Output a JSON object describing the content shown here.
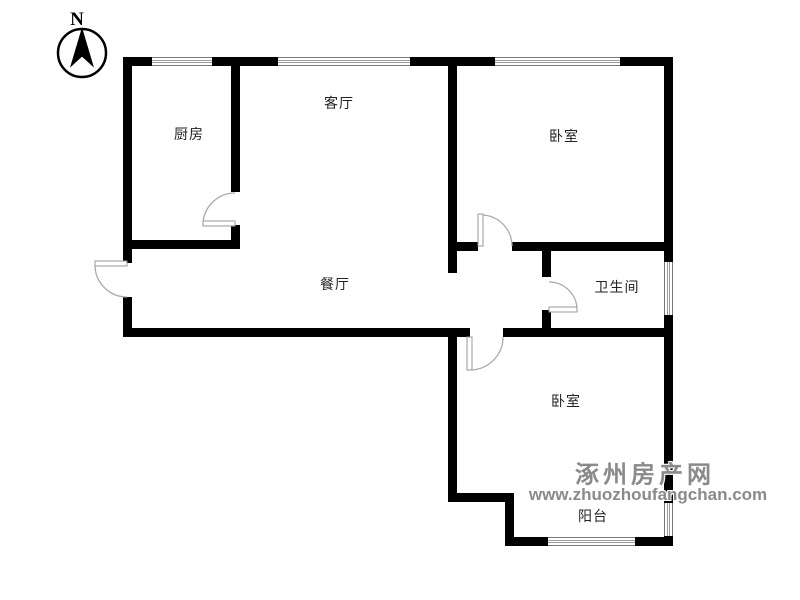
{
  "compass": {
    "north_label": "N"
  },
  "rooms": {
    "kitchen": {
      "label": "厨房"
    },
    "living_room": {
      "label": "客厅"
    },
    "bedroom_top": {
      "label": "卧室"
    },
    "dining_room": {
      "label": "餐厅"
    },
    "bathroom": {
      "label": "卫生间"
    },
    "bedroom_bottom": {
      "label": "卧室"
    },
    "balcony": {
      "label": "阳台"
    }
  },
  "watermark": {
    "site_name": "涿州房产网",
    "url": "www.zhuozhoufangchan.com",
    "color": "#8a8a8a"
  },
  "colors": {
    "wall": "#000000",
    "door_arc": "#aaaaaa",
    "background": "#ffffff"
  }
}
